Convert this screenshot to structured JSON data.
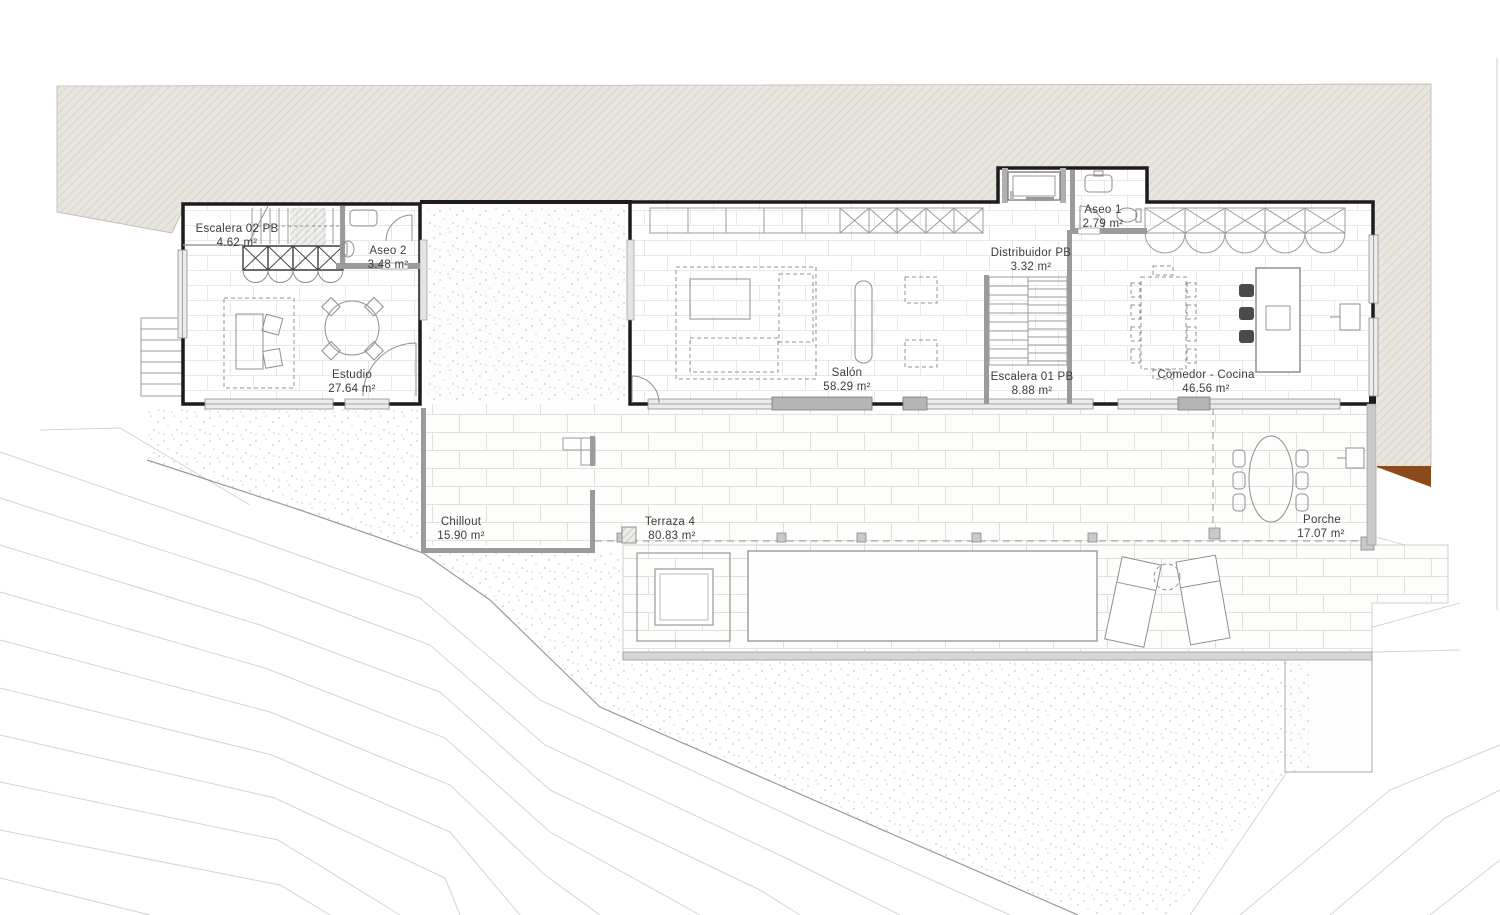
{
  "title": "Planta baja - floor plan",
  "rooms": [
    {
      "id": "escalera-02-pb",
      "name": "Escalera 02 PB",
      "area": "4.62 m²"
    },
    {
      "id": "aseo-2",
      "name": "Aseo 2",
      "area": "3.48 m²"
    },
    {
      "id": "estudio",
      "name": "Estudio",
      "area": "27.64 m²"
    },
    {
      "id": "salon",
      "name": "Salón",
      "area": "58.29 m²"
    },
    {
      "id": "distribuidor-pb",
      "name": "Distribuidor PB",
      "area": "3.32 m²"
    },
    {
      "id": "aseo-1",
      "name": "Aseo 1",
      "area": "2.79 m²"
    },
    {
      "id": "escalera-01-pb",
      "name": "Escalera 01 PB",
      "area": "8.88 m²"
    },
    {
      "id": "comedor-cocina",
      "name": "Comedor - Cocina",
      "area": "46.56 m²"
    },
    {
      "id": "chillout",
      "name": "Chillout",
      "area": "15.90 m²"
    },
    {
      "id": "terraza-4",
      "name": "Terraza 4",
      "area": "80.83 m²"
    },
    {
      "id": "porche",
      "name": "Porche",
      "area": "17.07 m²"
    }
  ],
  "colors": {
    "terrain_fill": "#e9e6e0",
    "terrain_hatch": "#dbd7cf",
    "exterior_wall": "#1c1c1c",
    "interior_wall": "#9b9b9b",
    "earth_brown": "#8a4a1c",
    "contour_line": "#d4d4d4",
    "label_text": "#3d3d3d"
  }
}
